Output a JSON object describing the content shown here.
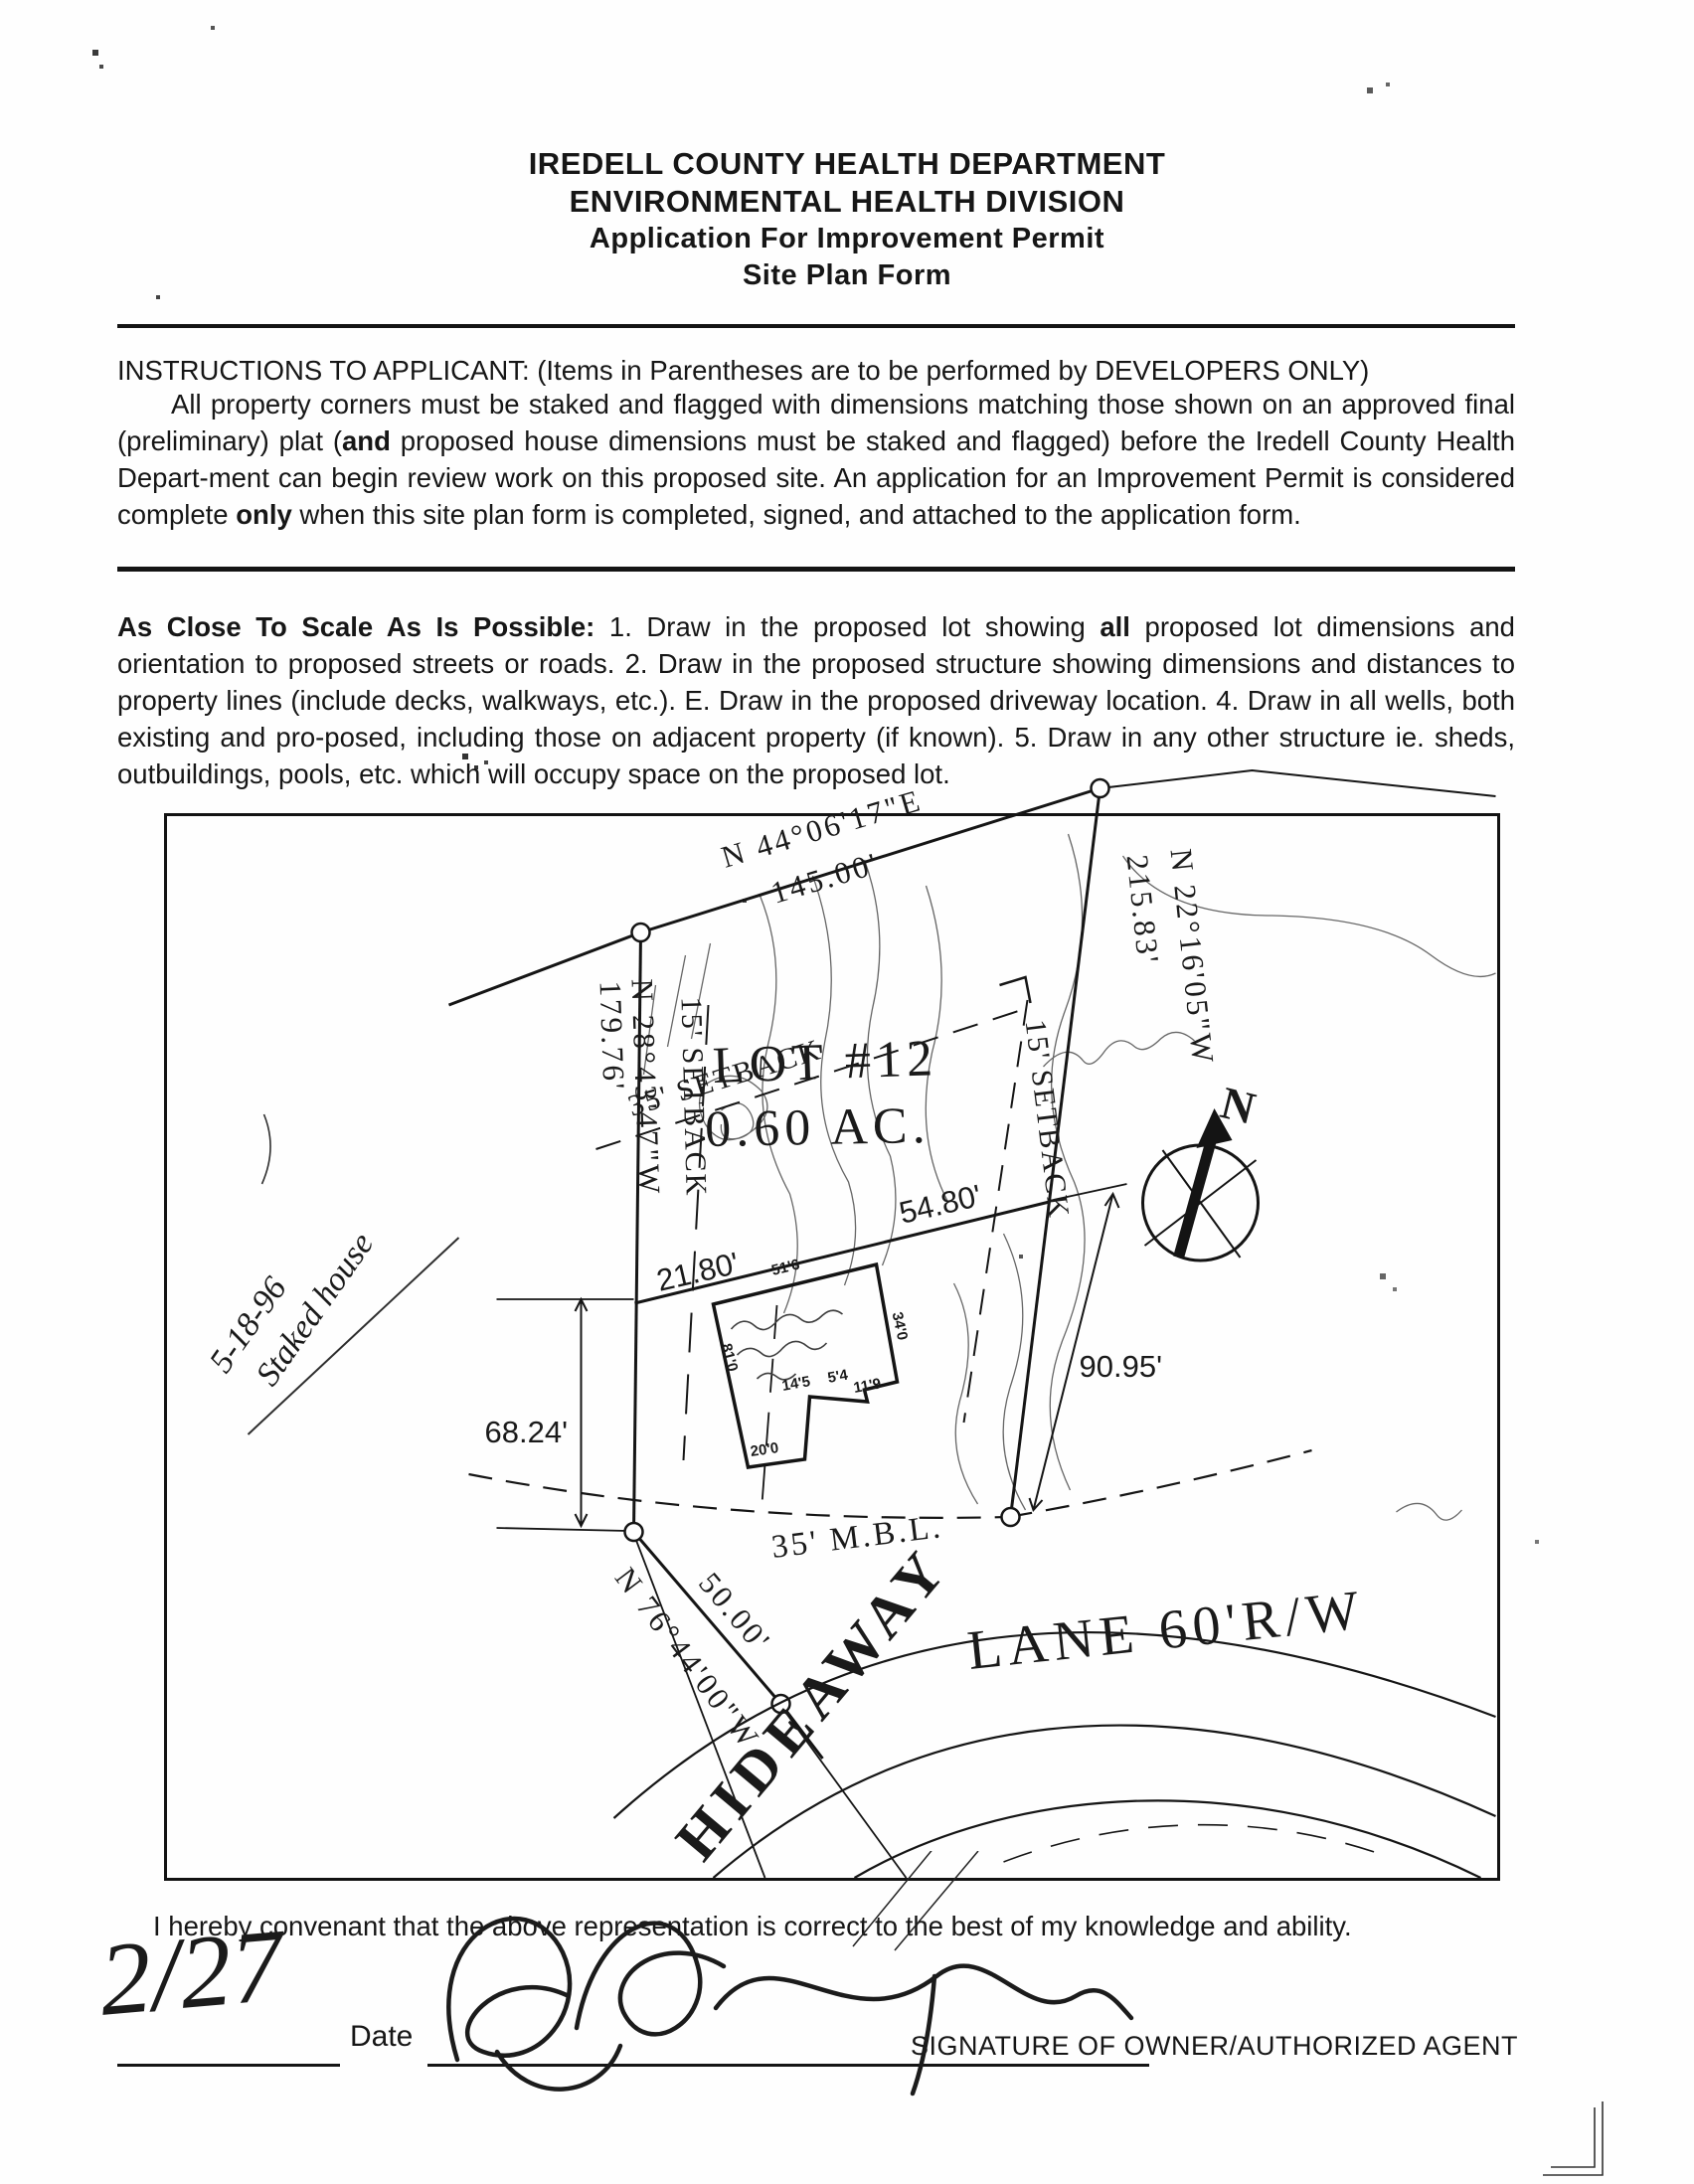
{
  "header": {
    "line1": "IREDELL COUNTY HEALTH DEPARTMENT",
    "line2": "ENVIRONMENTAL HEALTH DIVISION",
    "line3": "Application For Improvement Permit",
    "line4": "Site Plan Form"
  },
  "instructions": {
    "heading": "INSTRUCTIONS TO APPLICANT: (Items in Parentheses are to be performed by DEVELOPERS ONLY)",
    "body_1": "All property corners must be staked and flagged with dimensions matching those shown on an approved final (preliminary) plat (",
    "bold_and": "and",
    "body_2": " proposed house dimensions must be staked and flagged) before the Iredell County Health Depart-ment can begin review work on this proposed site. An application for an Improvement Permit is considered complete ",
    "bold_only": "only",
    "body_3": " when this site plan form is completed, signed, and attached to the application form."
  },
  "scale_note": {
    "lead": "As Close To Scale As Is Possible:",
    "body_1": " 1. Draw in the proposed lot showing ",
    "bold_all": "all",
    "body_2": " proposed lot dimensions and orientation to proposed streets or roads. 2. Draw in the proposed structure showing dimensions and distances to property lines (include decks, walkways, etc.). E. Draw in the proposed driveway location. 4. Draw in all wells, both existing and pro-posed, including those on adjacent property (if known). 5. Draw in any other structure ie. sheds, outbuildings, pools, etc. which will occupy space on the proposed lot."
  },
  "plan": {
    "lot_label": "LOT  #12",
    "lot_area": "0.60  AC.",
    "bearing_top": "N 44°06'17\"E",
    "bearing_top_len": "145.00'",
    "bearing_east": "N 22°16'05\"W",
    "bearing_east_len": "215.83'",
    "bearing_west": "N 28°43'47\"W",
    "bearing_west_len": "179.76'",
    "bearing_road": "N 76°44'00\"W",
    "bearing_road_len": "50.00'",
    "setback_35": "35'  SETBACK",
    "setback_15_left": "15'  SETBACK",
    "setback_15_right": "15'  SETBACK",
    "mbl": "35'  M.B.L.",
    "dim_front_west": "21.80'",
    "dim_front_east": "54.80'",
    "dim_left": "68.24'",
    "dim_right": "90.95'",
    "house": {
      "top": "51'6",
      "right": "34'0",
      "step_a": "14'5",
      "step_b": "5'4",
      "step_c": "11'9",
      "left": "81'0",
      "wing": "20'0"
    },
    "road_name": "HIDEAWAY",
    "road_label": "LANE  60'R/W",
    "compass_n": "N",
    "margin_note_line1": "5-18-96",
    "margin_note_line2": "Staked house"
  },
  "footer": {
    "covenant": "I hereby convenant that the above representation is correct to the best of my knowledge and ability.",
    "date_value": "2/27",
    "date_label": "Date",
    "signature_label": "SIGNATURE OF OWNER/AUTHORIZED AGENT"
  }
}
